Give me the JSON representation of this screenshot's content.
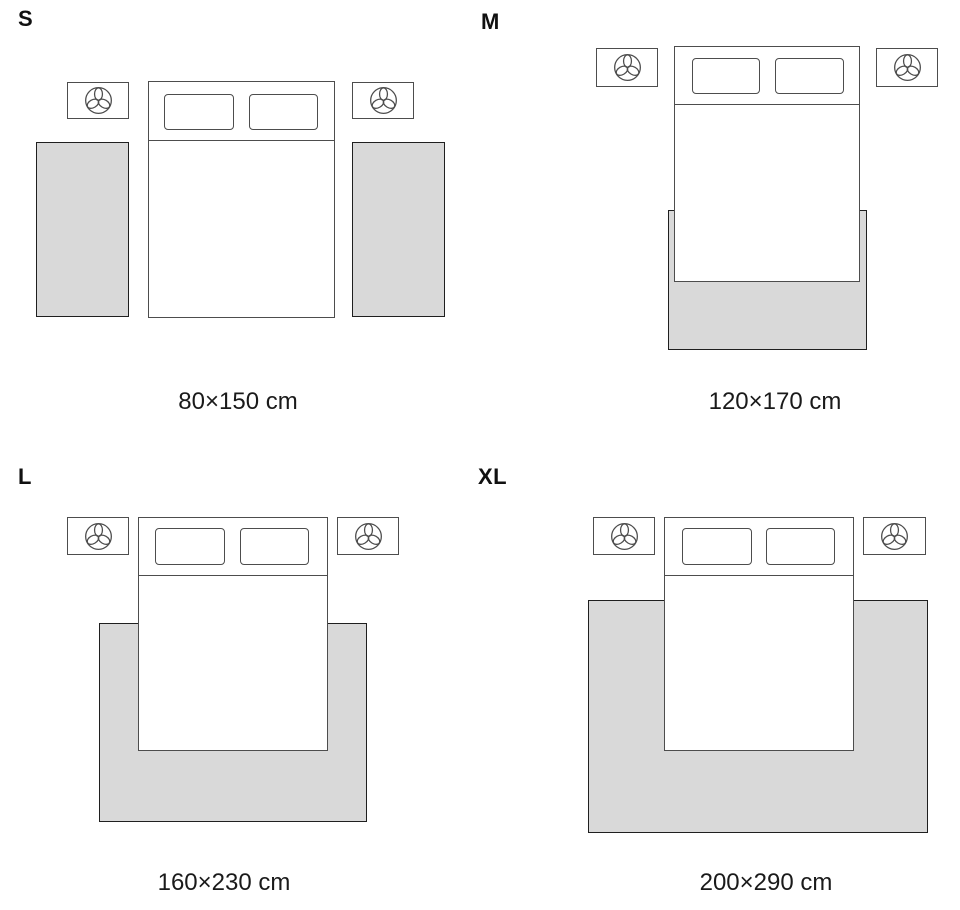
{
  "title": "Rug size guide — bedroom placement diagrams",
  "colors": {
    "background": "#ffffff",
    "rug_fill": "#d9d9d9",
    "rug_border": "#1f1f1f",
    "furniture_outline": "#4d4d4d",
    "text": "#111111"
  },
  "icons": {
    "nightstand_lamp": "three-leaf-plant-lamp-icon"
  },
  "sizes": [
    {
      "label": "S",
      "dimensions": "80×150 cm",
      "rug_layout": "two runner rugs beside bed"
    },
    {
      "label": "M",
      "dimensions": "120×170 cm",
      "rug_layout": "rug at foot of bed"
    },
    {
      "label": "L",
      "dimensions": "160×230 cm",
      "rug_layout": "rug under lower two-thirds of bed"
    },
    {
      "label": "XL",
      "dimensions": "200×290 cm",
      "rug_layout": "full-width rug under bed and beyond nightstands"
    }
  ]
}
